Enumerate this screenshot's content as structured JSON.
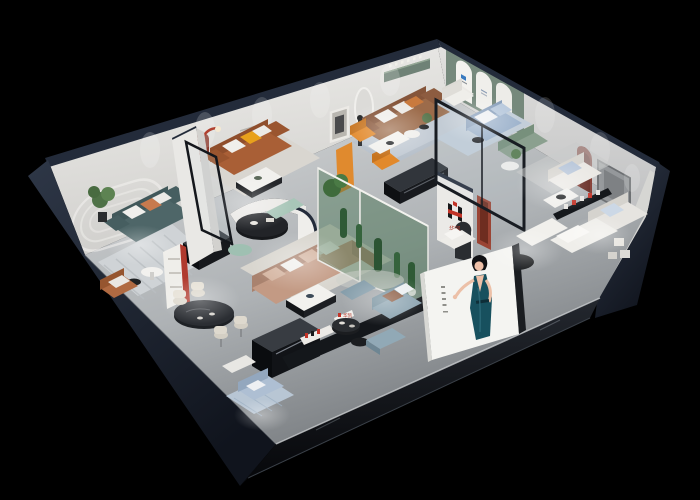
{
  "scene": {
    "type": "3d-isometric-cutaway-render",
    "description": "Aerial cutaway render of a furniture brand showroom with multiple furnished room displays",
    "background_color": "#000000",
    "wall_top_color": "#232b3a",
    "interior_wall_color": "#e8e6e2",
    "floor_color_light": "#cdd0d2",
    "floor_color_dark": "#74787c"
  },
  "brand": {
    "logo_mark": "H-monogram",
    "logo_text": "华凯",
    "logo_black": "#17181a",
    "logo_red": "#c23327"
  },
  "poster": {
    "subject": "fashion model in teal evening gown",
    "panel_color": "#f4f4f1",
    "dress_color": "#17505e",
    "caption_style": "small vertical caption strip"
  },
  "rooms": [
    {
      "id": "teal-sofa-lounge",
      "label": "Teal sofa lounge with molding wall"
    },
    {
      "id": "caramel-sofa-lounge",
      "label": "Caramel leather sofa lounge with red arch niche"
    },
    {
      "id": "brown-sofa-lounge",
      "label": "Brown sofa lounge with green display shelf"
    },
    {
      "id": "glass-blue-sofa-room",
      "label": "Glass-walled blue sofa room with arched niches"
    },
    {
      "id": "white-bedroom-suites",
      "label": "White bedroom suites"
    },
    {
      "id": "center-lounge",
      "label": "Central tan sectional lounge with curved wall"
    },
    {
      "id": "cactus-atrium",
      "label": "Green glass cactus atrium"
    },
    {
      "id": "dining-display",
      "label": "Black oval dining table display"
    },
    {
      "id": "front-showcase",
      "label": "Front showcase with slate leather sofa"
    },
    {
      "id": "corner-blue-sofa-display",
      "label": "Corner light-blue sofa display"
    }
  ]
}
